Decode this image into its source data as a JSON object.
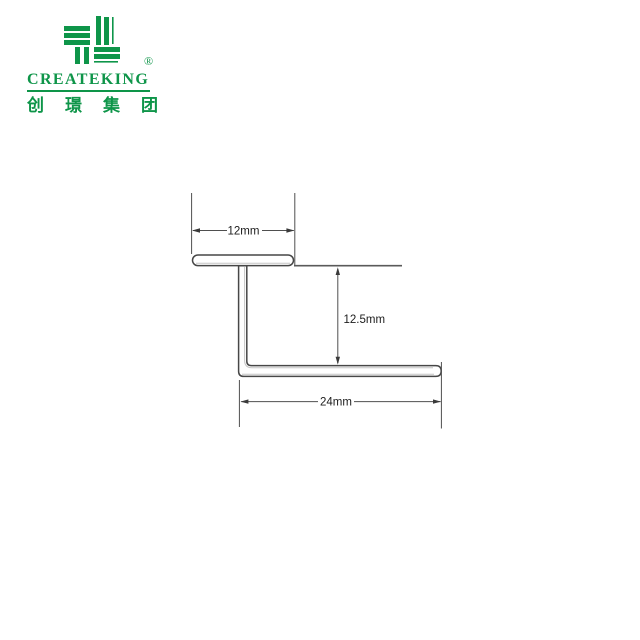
{
  "brand": {
    "name": "CREATEKING",
    "registered_mark": "®",
    "chinese_name": "创 璟 集 团",
    "brand_color": "#0E9549",
    "icons": {
      "logo": "createking-pinwheel-logo-icon"
    }
  },
  "diagram": {
    "dimensions": {
      "top_width": {
        "label": "12mm"
      },
      "height": {
        "label": "12.5mm"
      },
      "bottom_width": {
        "label": "24mm"
      }
    },
    "colors": {
      "outline": "#474747",
      "inner_shading": "#c6c6c6",
      "dimension_lines": "#4f4f4f",
      "label_text": "#1c1c1c"
    }
  }
}
